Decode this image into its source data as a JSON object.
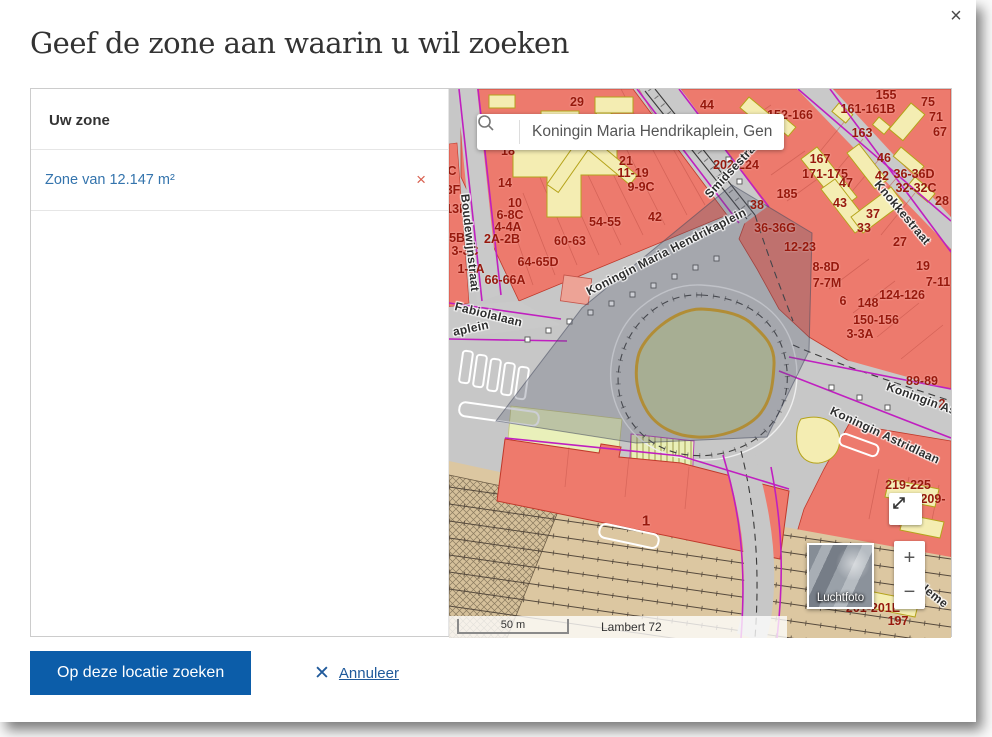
{
  "dialog": {
    "title": "Geef de zone aan waarin u wil zoeken",
    "close_icon": "×"
  },
  "panel": {
    "header": "Uw zone",
    "zone_label": "Zone van 12.147 m²",
    "remove_icon": "×"
  },
  "map": {
    "search": {
      "value": "Koningin Maria Hendrikaplein, Gent",
      "icon": "search-magnifier"
    },
    "controls": {
      "expand_icon": "expand-diagonal-arrows",
      "zoom_in": "+",
      "zoom_out": "−",
      "basemap_label": "Luchtfoto"
    },
    "scale": {
      "bar_label": "50 m",
      "projection": "Lambert 72"
    },
    "street_labels": [
      {
        "t": "Boudewijnstraat",
        "x": 16,
        "y": 98,
        "r": 84
      },
      {
        "t": "Fabiolalaan",
        "x": 6,
        "y": 210,
        "r": 14
      },
      {
        "t": "aplein",
        "x": 4,
        "y": 236,
        "r": -12
      },
      {
        "t": "Koningin Maria Hendrikaplein",
        "x": 138,
        "y": 196,
        "r": -27
      },
      {
        "t": "Smidsestraat",
        "x": 258,
        "y": 100,
        "r": -47
      },
      {
        "t": "Knokkestraat",
        "x": 428,
        "y": 86,
        "r": 50
      },
      {
        "t": "Koningin As",
        "x": 438,
        "y": 290,
        "r": 20
      },
      {
        "t": "Koningin Astridlaan",
        "x": 382,
        "y": 314,
        "r": 25
      },
      {
        "t": "Cleme",
        "x": 468,
        "y": 486,
        "r": 38
      }
    ],
    "house_numbers": [
      {
        "t": "29",
        "x": 128,
        "y": 13
      },
      {
        "t": "44",
        "x": 258,
        "y": 16
      },
      {
        "t": "152-166",
        "x": 341,
        "y": 26
      },
      {
        "t": "161-161B",
        "x": 419,
        "y": 20
      },
      {
        "t": "155",
        "x": 437,
        "y": 6
      },
      {
        "t": "75",
        "x": 479,
        "y": 13
      },
      {
        "t": "71",
        "x": 487,
        "y": 28
      },
      {
        "t": "67",
        "x": 491,
        "y": 43
      },
      {
        "t": "163",
        "x": 413,
        "y": 44
      },
      {
        "t": "46",
        "x": 435,
        "y": 69
      },
      {
        "t": "42",
        "x": 433,
        "y": 87
      },
      {
        "t": "36-36D",
        "x": 465,
        "y": 85
      },
      {
        "t": "32-32C",
        "x": 467,
        "y": 99
      },
      {
        "t": "28",
        "x": 493,
        "y": 112
      },
      {
        "t": "167",
        "x": 371,
        "y": 70
      },
      {
        "t": "171-175",
        "x": 376,
        "y": 85
      },
      {
        "t": "185",
        "x": 338,
        "y": 105
      },
      {
        "t": "47",
        "x": 397,
        "y": 94
      },
      {
        "t": "43",
        "x": 391,
        "y": 114
      },
      {
        "t": "37",
        "x": 424,
        "y": 125
      },
      {
        "t": "33",
        "x": 415,
        "y": 139
      },
      {
        "t": "27",
        "x": 451,
        "y": 153
      },
      {
        "t": "202-224",
        "x": 287,
        "y": 76
      },
      {
        "t": "38",
        "x": 308,
        "y": 116
      },
      {
        "t": "36-36G",
        "x": 326,
        "y": 139
      },
      {
        "t": "12-23",
        "x": 351,
        "y": 158
      },
      {
        "t": "8-8D",
        "x": 377,
        "y": 178
      },
      {
        "t": "7-7M",
        "x": 378,
        "y": 194
      },
      {
        "t": "19",
        "x": 474,
        "y": 177
      },
      {
        "t": "7-11",
        "x": 489,
        "y": 193
      },
      {
        "t": "124-126",
        "x": 453,
        "y": 206
      },
      {
        "t": "6",
        "x": 394,
        "y": 212
      },
      {
        "t": "148",
        "x": 419,
        "y": 214
      },
      {
        "t": "150-156",
        "x": 427,
        "y": 231
      },
      {
        "t": "3-3A",
        "x": 411,
        "y": 245
      },
      {
        "t": "89-89",
        "x": 473,
        "y": 292
      },
      {
        "t": "2",
        "x": 493,
        "y": 315
      },
      {
        "t": "18",
        "x": 59,
        "y": 62
      },
      {
        "t": "14",
        "x": 56,
        "y": 94
      },
      {
        "t": "10",
        "x": 66,
        "y": 114
      },
      {
        "t": "6-8C",
        "x": 61,
        "y": 126
      },
      {
        "t": "4-4A",
        "x": 59,
        "y": 138
      },
      {
        "t": "2A-2B",
        "x": 53,
        "y": 150
      },
      {
        "t": "21",
        "x": 177,
        "y": 72
      },
      {
        "t": "11-19",
        "x": 184,
        "y": 84
      },
      {
        "t": "9-9C",
        "x": 192,
        "y": 98
      },
      {
        "t": "42",
        "x": 206,
        "y": 128
      },
      {
        "t": "54-55",
        "x": 156,
        "y": 133
      },
      {
        "t": "60-63",
        "x": 121,
        "y": 152
      },
      {
        "t": "64-65D",
        "x": 89,
        "y": 173
      },
      {
        "t": "66-66A",
        "x": 56,
        "y": 191
      },
      {
        "t": "C",
        "x": 3,
        "y": 82
      },
      {
        "t": "3F",
        "x": 4,
        "y": 101
      },
      {
        "t": "13F",
        "x": 7,
        "y": 120
      },
      {
        "t": "-5B",
        "x": 6,
        "y": 149
      },
      {
        "t": "3-3C",
        "x": 16,
        "y": 162
      },
      {
        "t": "1-1A",
        "x": 22,
        "y": 180
      },
      {
        "t": "1",
        "x": 197,
        "y": 432,
        "s": 15
      },
      {
        "t": "219-225",
        "x": 459,
        "y": 396
      },
      {
        "t": "209-",
        "x": 484,
        "y": 410
      },
      {
        "t": "201-201E",
        "x": 424,
        "y": 519
      },
      {
        "t": "197",
        "x": 449,
        "y": 532
      }
    ]
  },
  "footer": {
    "primary_button": "Op deze locatie zoeken",
    "cancel_icon": "✕",
    "cancel_label": "Annuleer"
  },
  "colors": {
    "primary_blue": "#0c5da9",
    "link_blue": "#3474ad",
    "cancel_blue": "#205a9b",
    "remove_red": "#d9604f",
    "text_dark": "#333333",
    "map_red": "#ed7a6d",
    "map_cream": "#f4edb2",
    "map_green": "#cbd1a3",
    "map_purple": "#c01fc0",
    "map_tan": "#dcc7a1",
    "zone_overlay": "rgba(85,92,112,0.3)"
  }
}
